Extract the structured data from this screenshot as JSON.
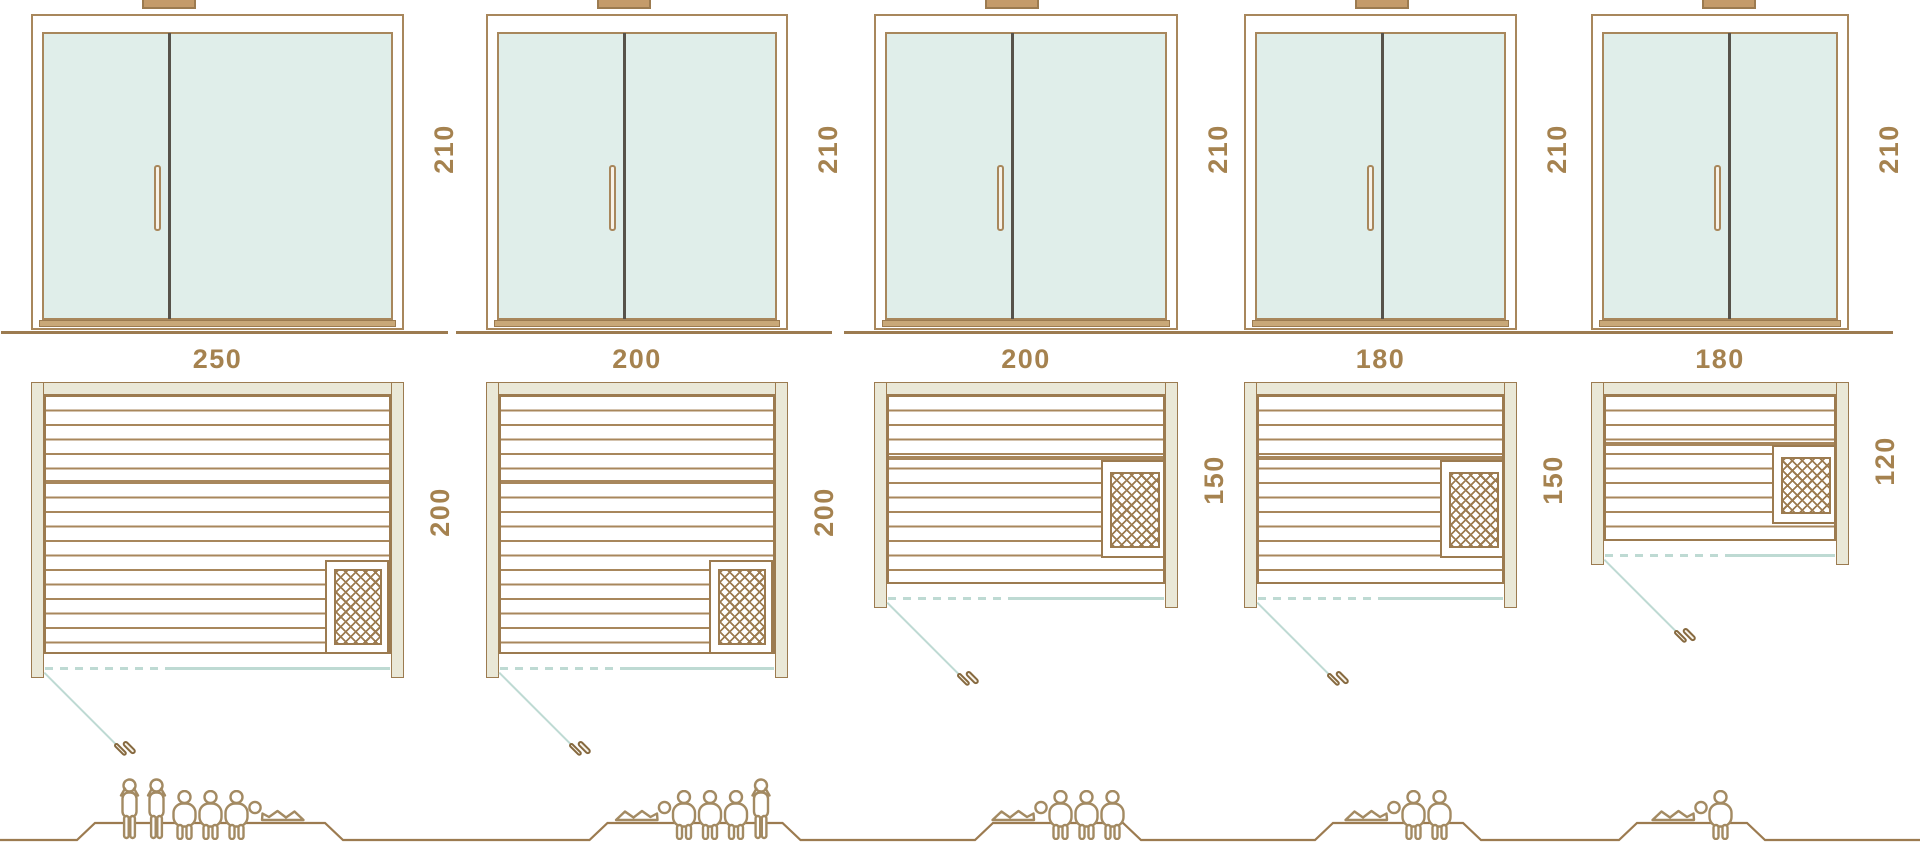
{
  "figure": {
    "name": "sauna-size-comparison-diagram"
  },
  "colors": {
    "outline": "#9c7b50",
    "outline_soft": "#a8875c",
    "wall_fill": "#eae8d7",
    "glass_fill": "#e0eeea",
    "glass_line": "#bedad3",
    "divider": "#57524a",
    "label_text": "#a5824f",
    "vent_fill": "#c49b6a",
    "handle_fill": "#f7f2e8",
    "sill_fill": "#c9a878",
    "people_stroke": "#a38a62",
    "ground_line": "#9c7b50"
  },
  "saunas": [
    {
      "name": "sauna-250x200",
      "width_label": "250",
      "depth_label": "200",
      "height_label": "210",
      "heater_position": "bottom-right",
      "door_side": "left",
      "capacity": 6,
      "people": [
        "standing",
        "standing",
        "seated",
        "seated",
        "seated",
        "lying"
      ]
    },
    {
      "name": "sauna-200x200",
      "width_label": "200",
      "depth_label": "200",
      "height_label": "210",
      "heater_position": "bottom-right",
      "door_side": "left",
      "capacity": 5,
      "people": [
        "lying",
        "seated",
        "seated",
        "seated",
        "standing"
      ]
    },
    {
      "name": "sauna-200x150",
      "width_label": "200",
      "depth_label": "150",
      "height_label": "210",
      "heater_position": "right-middle",
      "door_side": "left",
      "capacity": 4,
      "people": [
        "lying",
        "seated",
        "seated",
        "seated"
      ]
    },
    {
      "name": "sauna-180x150",
      "width_label": "180",
      "depth_label": "150",
      "height_label": "210",
      "heater_position": "right-middle",
      "door_side": "left",
      "capacity": 3,
      "people": [
        "lying",
        "seated",
        "seated"
      ]
    },
    {
      "name": "sauna-180x120",
      "width_label": "180",
      "depth_label": "120",
      "height_label": "210",
      "heater_position": "right-middle",
      "door_side": "left",
      "capacity": 2,
      "people": [
        "lying",
        "seated"
      ]
    }
  ]
}
